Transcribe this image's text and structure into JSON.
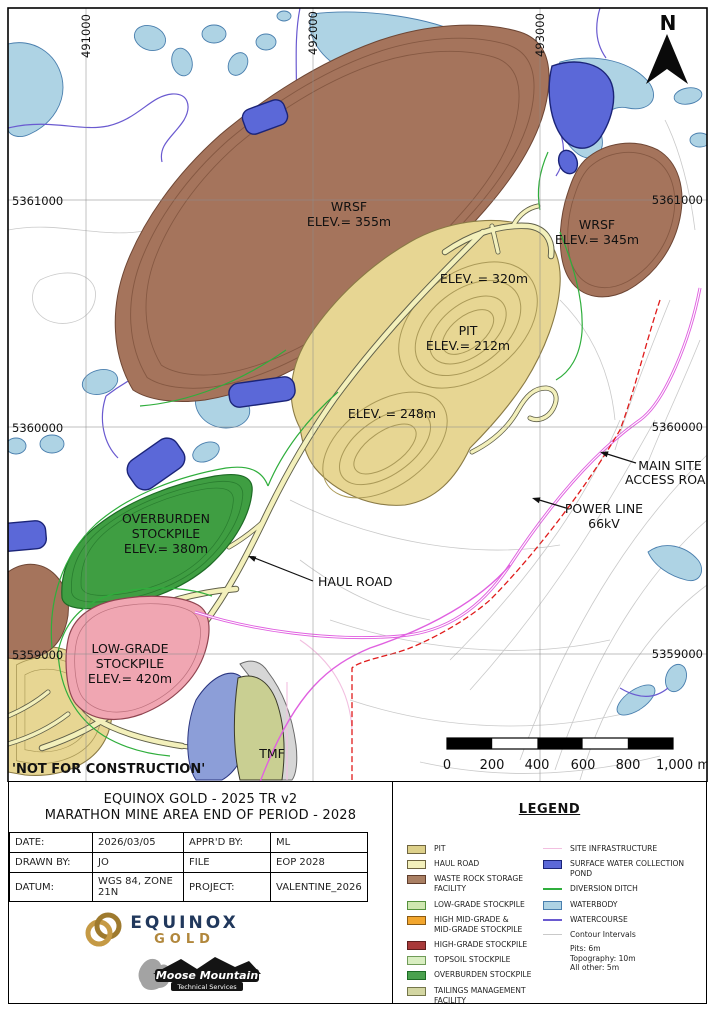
{
  "sheet": {
    "not_for_construction": "'NOT FOR CONSTRUCTION'",
    "north_label": "N"
  },
  "map": {
    "grid": {
      "top": [
        "491000",
        "492000",
        "493000"
      ],
      "left": [
        "5361000",
        "5360000",
        "5359000"
      ],
      "right": [
        "5361000",
        "5360000",
        "5359000"
      ]
    },
    "labels": {
      "wrsf_main": [
        "WRSF",
        "ELEV.= 355m"
      ],
      "wrsf_east": [
        "WRSF",
        "ELEV.= 345m"
      ],
      "pit_rim": "ELEV. = 320m",
      "pit": [
        "PIT",
        "ELEV.= 212m"
      ],
      "pit_south": "ELEV. = 248m",
      "overburden": [
        "OVERBURDEN",
        "STOCKPILE",
        "ELEV.= 380m"
      ],
      "low_grade": [
        "LOW-GRADE",
        "STOCKPILE",
        "ELEV.= 420m"
      ],
      "tmf": "TMF",
      "haul_road": "HAUL ROAD",
      "main_site_access": [
        "MAIN SITE",
        "ACCESS ROAD"
      ],
      "power_line": [
        "POWER LINE",
        "66kV"
      ]
    },
    "scalebar": [
      "0",
      "200",
      "400",
      "600",
      "800",
      "1,000 m"
    ]
  },
  "colors": {
    "waterbody": "#aed3e4",
    "waterbody_border": "#4a7fae",
    "pond": "#5b68d8",
    "pond_border": "#1b2478",
    "watercourse": "#6a5ad0",
    "ditch": "#2fae3c",
    "contour": "#c9c9c9",
    "wrsf": "#a5745c",
    "wrsf_border": "#6e4634",
    "wrsf_contour": "#7d513c",
    "pit": "#e7d693",
    "pit_border": "#8a7a45",
    "pit_contour": "#ab9a58",
    "road_fill": "#f3f0bb",
    "road_casing": "#5f5f49",
    "overburden": "#3f9e42",
    "overburden_border": "#1d6b25",
    "low_grade": "#f0a6b2",
    "low_grade_border": "#8f4450",
    "tmf_fill": "#c9cf92",
    "tmf_pond": "#8c9ed8",
    "dam": "#d6d6d6",
    "power_line": "#e01b1b",
    "access_road": "#e061e0",
    "site_infra": "#f2bfe0",
    "grid": "#8c8c8c"
  },
  "title_block": {
    "line1": "EQUINOX GOLD - 2025 TR v2",
    "line2": "MARATHON MINE AREA END OF PERIOD - 2028",
    "rows": [
      {
        "k1": "DATE:",
        "v1": "2026/03/05",
        "k2": "APPR'D BY:",
        "v2": "ML"
      },
      {
        "k1": "DRAWN BY:",
        "v1": "JO",
        "k2": "FILE",
        "v2": "EOP 2028"
      },
      {
        "k1": "DATUM:",
        "v1": "WGS 84, ZONE 21N",
        "k2": "PROJECT:",
        "v2": "VALENTINE_2026"
      }
    ]
  },
  "legend": {
    "title": "LEGEND",
    "left": [
      {
        "label": "PIT",
        "color": "#ddd08a",
        "border": "#6e6440"
      },
      {
        "label": "HAUL ROAD",
        "color": "#f3f0bb",
        "border": "#6e6440"
      },
      {
        "label": "WASTE ROCK STORAGE FACILITY",
        "color": "#a97f63",
        "border": "#5f3d2c"
      },
      {
        "label": "LOW-GRADE STOCKPILE",
        "color": "#cfe7b0",
        "border": "#55913d"
      },
      {
        "label": "HIGH MID-GRADE &",
        "label2": "MID-GRADE STOCKPILE",
        "color": "#f2a62e",
        "border": "#8a5a14"
      },
      {
        "label": "HIGH-GRADE STOCKPILE",
        "color": "#a83a3a",
        "border": "#5e1f1f"
      },
      {
        "label": "TOPSOIL STOCKPILE",
        "color": "#d9eec1",
        "border": "#6f9b58"
      },
      {
        "label": "OVERBURDEN STOCKPILE",
        "color": "#4aa14e",
        "border": "#1d6b25"
      },
      {
        "label": "TAILINGS MANAGEMENT FACILITY",
        "color": "#d3d6a2",
        "border": "#74764a"
      }
    ],
    "right": [
      {
        "type": "line",
        "label": "SITE INFRASTRUCTURE",
        "color": "#f2bfe0"
      },
      {
        "type": "swatch",
        "label": "SURFACE WATER COLLECTION POND",
        "color": "#5b68d8",
        "border": "#1b2478"
      },
      {
        "type": "line",
        "label": "DIVERSION DITCH",
        "color": "#2fae3c"
      },
      {
        "type": "swatch",
        "label": "WATERBODY",
        "color": "#aed3e4",
        "border": "#4a7fae"
      },
      {
        "type": "line",
        "label": "WATERCOURSE",
        "color": "#6a5ad0"
      },
      {
        "type": "line",
        "label": "Contour Intervals",
        "color": "#c9c9c9",
        "sub": [
          "Pits: 6m",
          "Topography: 10m",
          "All other: 5m"
        ]
      }
    ]
  },
  "logos": {
    "equinox": {
      "name": "EQUINOX",
      "sub": "GOLD"
    },
    "moose": {
      "name": "Moose Mountain",
      "sub": "Technical Services"
    }
  }
}
